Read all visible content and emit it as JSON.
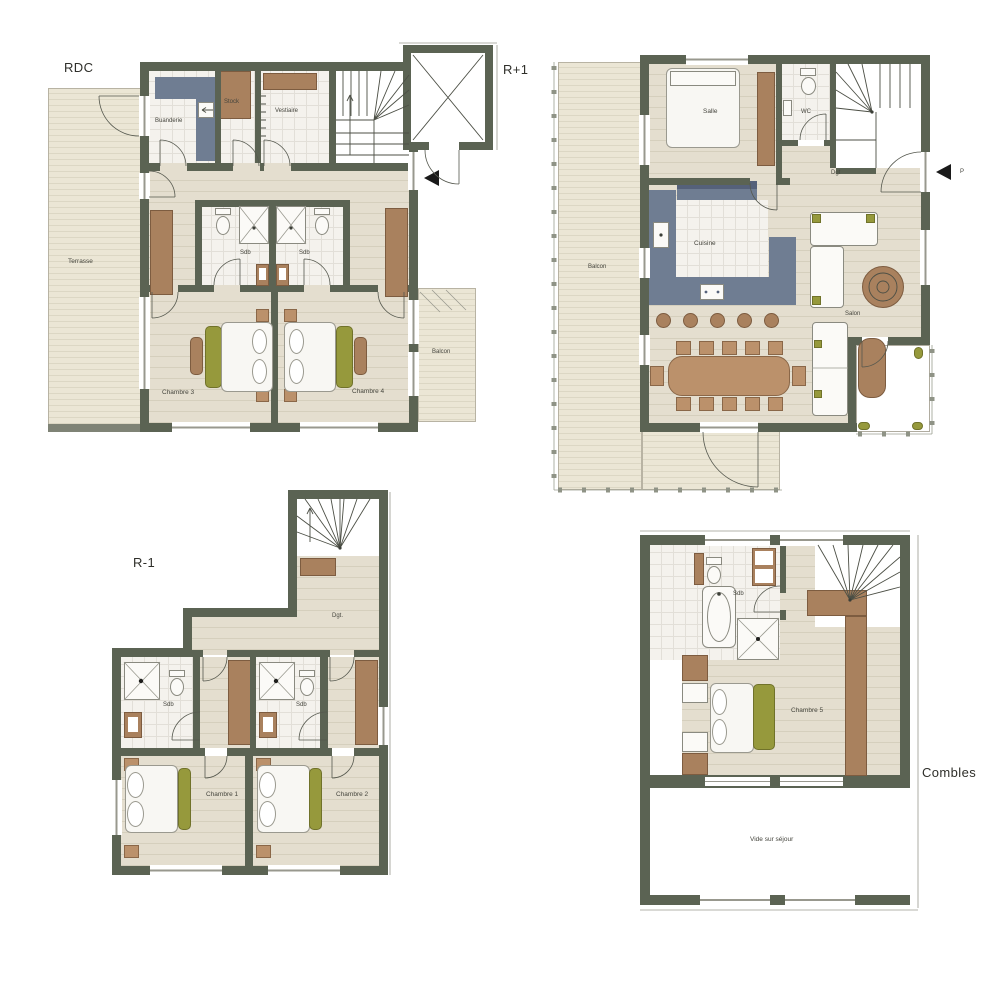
{
  "sheet": {
    "background": "#ffffff"
  },
  "palette": {
    "wall": "#5b6353",
    "wood_floor": "#e4decf",
    "deck_floor": "#ebe6d5",
    "tile_floor": "#f4f2ed",
    "kitchen_blue": "#6f7d92",
    "kitchen_blue_dark": "#55617a",
    "furniture_brown": "#a9815e",
    "table_tan": "#bb916b",
    "accent_olive": "#96993c",
    "arrow_black": "#1a1a1a"
  },
  "plans": {
    "rdc": {
      "title": "RDC",
      "rooms": {
        "terrasse": "Terrasse",
        "buanderie": "Buanderie",
        "stock": "Stock",
        "vestiaire": "Vestiaire",
        "sdb1": "Sdb",
        "sdb2": "Sdb",
        "chambre3": "Chambre 3",
        "chambre4": "Chambre 4",
        "balcon": "Balcon"
      }
    },
    "r1": {
      "title": "R+1",
      "rooms": {
        "balcon": "Balcon",
        "salle": "Salle",
        "wc": "WC",
        "dgt": "Dgt",
        "cuisine": "Cuisine",
        "salon": "Salon"
      },
      "entrance_label": "P"
    },
    "rm1": {
      "title": "R-1",
      "rooms": {
        "dgt": "Dgt.",
        "sdb1": "Sdb",
        "sdb2": "Sdb",
        "chambre1": "Chambre 1",
        "chambre2": "Chambre 2"
      }
    },
    "combles": {
      "title": "Combles",
      "rooms": {
        "sdb": "Sdb",
        "chambre5": "Chambre 5",
        "vide": "Vide sur séjour"
      }
    }
  }
}
